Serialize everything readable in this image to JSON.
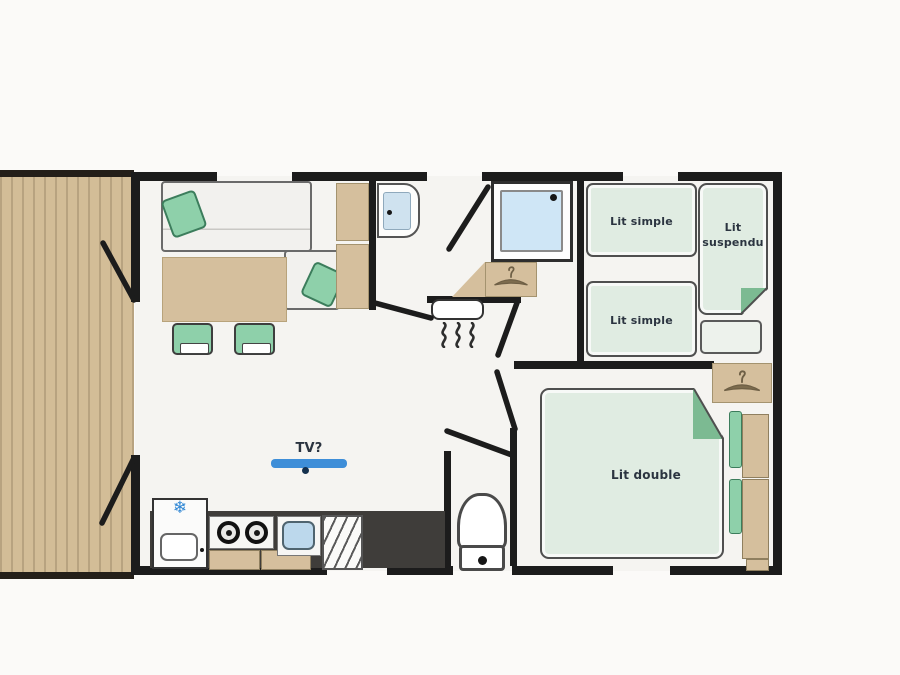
{
  "labels": {
    "tv": "TV?",
    "bed_simple_1": "Lit simple",
    "bed_simple_2": "Lit simple",
    "bed_suspended_line1": "Lit",
    "bed_suspended_line2": "suspendu",
    "bed_double": "Lit double"
  },
  "icons": {
    "snowflake": "❄",
    "hanger": "clothes-hanger",
    "heat_waves": "heat-squiggles",
    "door_swings": "door-leaf-lines"
  },
  "colors": {
    "wall": "#1c1c1c",
    "deck": "#d3bd97",
    "furniture-tan": "#d5bf9d",
    "bed-green": "#e0ece2",
    "fold-green": "#7cba92",
    "accent-green": "#8ed0aa",
    "water-blue": "#cfe6f6",
    "sink-blue": "#bcd8ec",
    "tv-blue": "#3e8ed8",
    "counter-dark": "#3f3d3a",
    "text-dark": "#2b3440"
  }
}
